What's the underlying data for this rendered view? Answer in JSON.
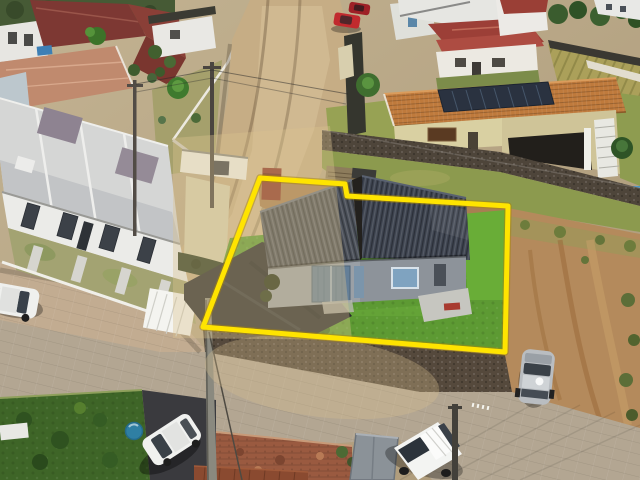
{
  "meta": {
    "domain": "Natural-Image",
    "description": "Aerial drone photo of a suburban Brazilian neighborhood. A single-storey house with a dark corrugated two-panel roof, blue double door and bright lawn is highlighted with a yellow property-boundary polygon (real-estate listing style). Surroundings: row of white townhouses with red/maroon tiled roofs at top-left, a sandy street descending from the top, a cream house with orange tile roof and solar panels upper-right, a stone retaining wall, a bare dirt slope on the right, a paver street across the bottom with parked cars and a white van. A translucent beige watermark overlays the centre-left.",
    "canvas": {
      "width": 640,
      "height": 480
    }
  },
  "property_outline": {
    "points": "260,178 345,184 347,196 508,206 505,352 203,327",
    "stroke_color": "#ffe400",
    "under_stroke_color": "#a8860a",
    "stroke_width": 5
  },
  "watermark": {
    "band_points": "173,138 330,126 352,340 173,338",
    "fill": "#d9c28e",
    "band_opacity": "0.38",
    "blob_opacity": "0.32"
  },
  "palette": {
    "lawn": "#5d9a33",
    "lawn_bright": "#69ad37",
    "dirt_yard": "#a87f52",
    "dirt_slope": "#b48a5c",
    "street_sand": "#c6ad85",
    "street_pavers": "#b3a692",
    "roof_left": "#4a4f58",
    "roof_right": "#3e4450",
    "orange_roof": "#bf7a3c",
    "solar_panel": "#2a3240",
    "maroon_roof": "#7d3833",
    "salmon_roof": "#c08a6e",
    "townhouse_roof": "#d5d6d5",
    "asphalt": "#27292d",
    "stone_wall": "#4e453a",
    "grass_dark": "#3e6527",
    "hedge": "#2c3a22"
  },
  "vehicles": [
    {
      "name": "red-car-upper-street",
      "color": "#c12a2e"
    },
    {
      "name": "dark-red-car-upper-street",
      "color": "#9e2026"
    },
    {
      "name": "white-hatchback-left-street",
      "color": "#eff0ee"
    },
    {
      "name": "white-sedan-bottom-driveway",
      "color": "#f0f1ef"
    },
    {
      "name": "white-van-bottom-right",
      "color": "#f3f4f2"
    },
    {
      "name": "silver-car-right-slope",
      "color": "#b9bdc1"
    }
  ],
  "landmarks": {
    "main_house_door_color": "#647f98",
    "blue_barrel_color": "#2f7fa3",
    "red_container_color": "#8c3426",
    "pool_color": "#4a94c4"
  }
}
